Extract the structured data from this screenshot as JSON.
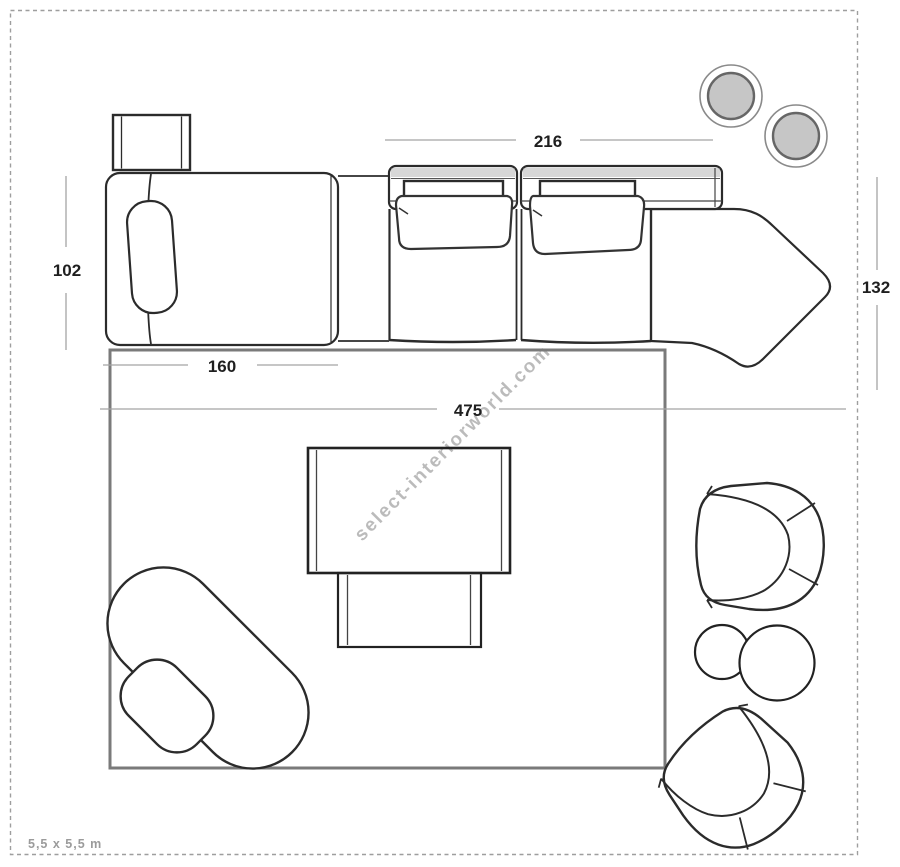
{
  "plan": {
    "watermark": "select-interiorworld.com",
    "scale_label": "5,5 x 5,5 m"
  },
  "dimensions": {
    "seat_section_width": "216",
    "chaise_depth": "102",
    "corner_unit_depth": "132",
    "chaise_width": "160",
    "sofa_total_width": "475"
  },
  "furniture": {
    "items": [
      "side-table",
      "chaise-longue-with-pillow",
      "sofa-seat-module-left",
      "sofa-seat-module-right",
      "sofa-corner-end-unit",
      "rug",
      "coffee-table",
      "side-bench",
      "lounge-chair-with-ottoman",
      "tub-armchair-upper",
      "tub-armchair-lower",
      "duo-round-side-tables",
      "pouf-upper",
      "pouf-lower"
    ]
  },
  "colors": {
    "outline": "#2b2b2b",
    "rug_border": "#7a7a7a",
    "dimension_line": "#a3a3a3",
    "dimension_text": "#1f1f1f",
    "pouf_fill": "#c6c6c6",
    "pouf_ring": "#666666",
    "watermark": "#b4b4b4",
    "frame_dash": "#9e9e9e",
    "scale_text": "#9b9b9b"
  }
}
